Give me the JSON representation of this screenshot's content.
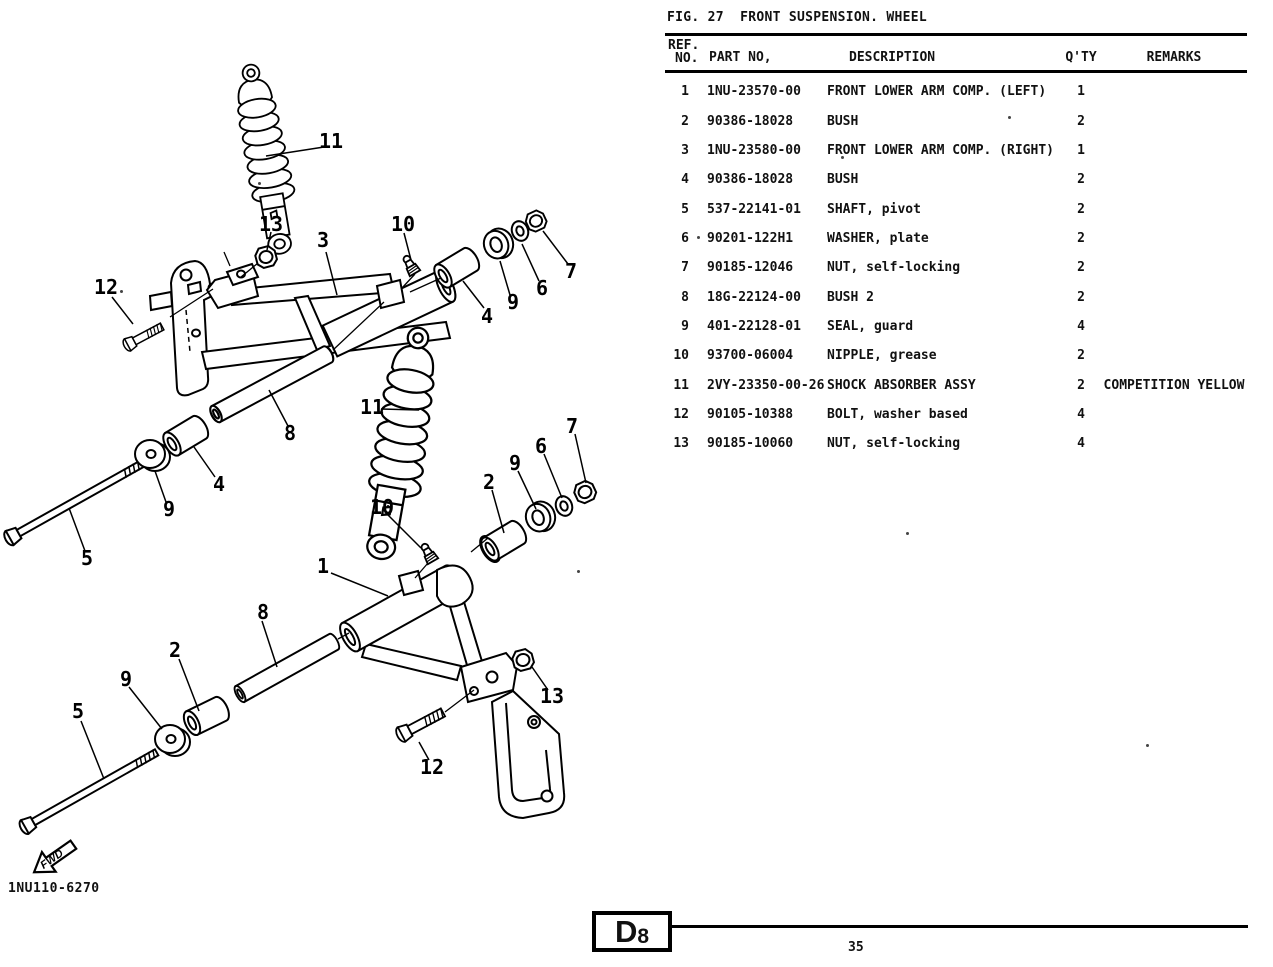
{
  "page": {
    "figure_title": "FIG. 27  FRONT SUSPENSION. WHEEL",
    "drawing_number": "1NU110-6270",
    "section_letter": "D",
    "section_digit": "8",
    "page_number": "35",
    "fwd_label": "FWD"
  },
  "table": {
    "headers": {
      "ref_line1": "REF.",
      "ref_line2": "NO.",
      "part_no": "PART NO,",
      "description": "DESCRIPTION",
      "qty": "Q'TY",
      "remarks": "REMARKS"
    },
    "rows": [
      {
        "ref": "1",
        "part_no": "1NU-23570-00",
        "description": "FRONT LOWER ARM COMP. (LEFT)",
        "qty": "1",
        "remarks": ""
      },
      {
        "ref": "2",
        "part_no": "90386-18028",
        "description": "BUSH",
        "qty": "2",
        "remarks": ""
      },
      {
        "ref": "3",
        "part_no": "1NU-23580-00",
        "description": "FRONT LOWER ARM COMP. (RIGHT)",
        "qty": "1",
        "remarks": ""
      },
      {
        "ref": "4",
        "part_no": "90386-18028",
        "description": "BUSH",
        "qty": "2",
        "remarks": ""
      },
      {
        "ref": "5",
        "part_no": "537-22141-01",
        "description": "SHAFT, pivot",
        "qty": "2",
        "remarks": ""
      },
      {
        "ref": "6",
        "part_no": "90201-122H1",
        "description": "WASHER, plate",
        "qty": "2",
        "remarks": ""
      },
      {
        "ref": "7",
        "part_no": "90185-12046",
        "description": "NUT, self-locking",
        "qty": "2",
        "remarks": ""
      },
      {
        "ref": "8",
        "part_no": "18G-22124-00",
        "description": "BUSH 2",
        "qty": "2",
        "remarks": ""
      },
      {
        "ref": "9",
        "part_no": "401-22128-01",
        "description": "SEAL, guard",
        "qty": "4",
        "remarks": ""
      },
      {
        "ref": "10",
        "part_no": "93700-06004",
        "description": "NIPPLE, grease",
        "qty": "2",
        "remarks": ""
      },
      {
        "ref": "11",
        "part_no": "2VY-23350-00-26",
        "description": "SHOCK ABSORBER ASSY",
        "qty": "2",
        "remarks": "COMPETITION YELLOW"
      },
      {
        "ref": "12",
        "part_no": "90105-10388",
        "description": "BOLT, washer based",
        "qty": "4",
        "remarks": ""
      },
      {
        "ref": "13",
        "part_no": "90185-10060",
        "description": "NUT, self-locking",
        "qty": "4",
        "remarks": ""
      }
    ]
  },
  "diagram": {
    "callouts": {
      "c11_top_shock": "11",
      "c13_top_nut": "13",
      "c3_upper_arm": "3",
      "c10_top_nipple": "10",
      "c12_left_bolt": "12",
      "c4_top_bush": "4",
      "c9_top_seal": "9",
      "c6_top_washer": "6",
      "c7_top_nut": "7",
      "c8_upper_tube": "8",
      "c4_mid_bush": "4",
      "c9_mid_disc": "9",
      "c5_upper_shaft": "5",
      "c11_mid_shock": "11",
      "c7_right_nut": "7",
      "c6_right_washer": "6",
      "c9_right_seal": "9",
      "c2_right_bush": "2",
      "c10_mid_nipple": "10",
      "c1_lower_arm": "1",
      "c8_lower_tube": "8",
      "c2_lower_bush": "2",
      "c9_lower_disc": "9",
      "c5_lower_shaft": "5",
      "c13_bracket_nut": "13",
      "c12_bracket_bolt": "12"
    }
  }
}
